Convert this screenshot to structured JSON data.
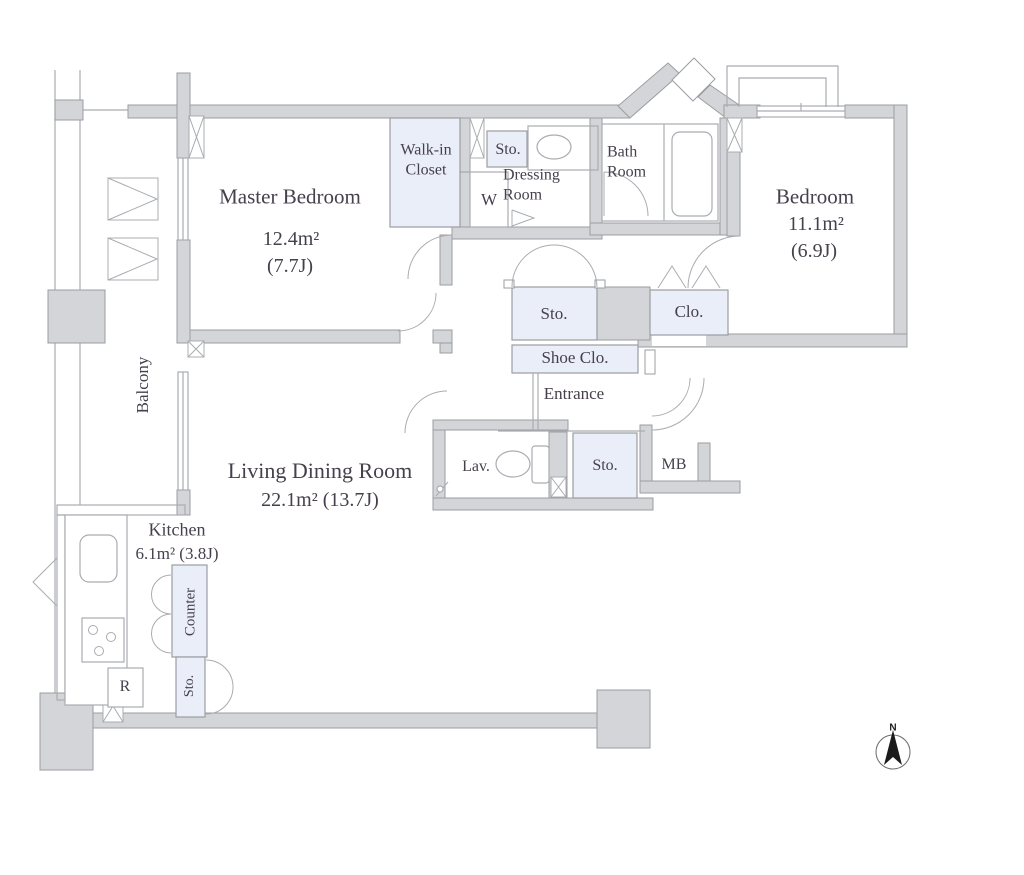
{
  "title": "Apartment floor plan",
  "colors": {
    "wall_fill": "#d3d5d8",
    "wall_stroke": "#9b9da1",
    "storage_fill": "#e9eef8",
    "line": "#a9acb0",
    "text": "#46404c",
    "compass": "#1a1a1a"
  },
  "rooms": {
    "master_bedroom": {
      "name": "Master Bedroom",
      "area": "12.4m²",
      "tatami": "(7.7J)"
    },
    "bedroom": {
      "name": "Bedroom",
      "area": "11.1m²",
      "tatami": "(6.9J)"
    },
    "living_dining": {
      "name": "Living Dining Room",
      "area": "22.1m²  (13.7J)"
    },
    "kitchen": {
      "name": "Kitchen",
      "area": "6.1m²  (3.8J)"
    },
    "walk_in_closet": {
      "name": "Walk-in Closet"
    },
    "dressing_room": {
      "name": "Dressing Room"
    },
    "bath_room": {
      "name": "Bath Room"
    },
    "balcony": {
      "name": "Balcony"
    },
    "entrance": {
      "name": "Entrance"
    },
    "lavatory": {
      "name": "Lav."
    },
    "washing_machine": {
      "name": "W"
    },
    "refrigerator": {
      "name": "R"
    },
    "meter_box": {
      "name": "MB"
    },
    "counter": {
      "name": "Counter"
    },
    "shoe_closet": {
      "name": "Shoe Clo."
    },
    "closet": {
      "name": "Clo."
    },
    "storage_dressing": {
      "name": "Sto."
    },
    "storage_hall": {
      "name": "Sto."
    },
    "storage_entrance": {
      "name": "Sto."
    },
    "storage_kitchen": {
      "name": "Sto."
    }
  },
  "compass": {
    "label": "N"
  }
}
